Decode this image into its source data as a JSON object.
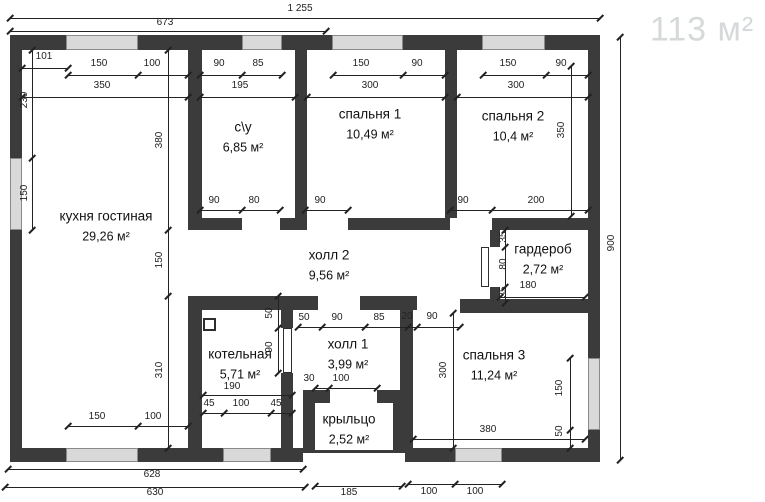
{
  "watermark": {
    "text": "113 м²"
  },
  "colors": {
    "background": "#ffffff",
    "wall": "#3b3b3b",
    "window": "#d9d9d9",
    "dim": "#222222",
    "room_text": "#111111",
    "watermark": "#d6d9da"
  },
  "rooms": [
    {
      "name": "кухня гостиная",
      "area": "29,26 м²",
      "cx": 106,
      "cy": 226,
      "w": 112
    },
    {
      "name": "с\\у",
      "area": "6,85 м²",
      "cx": 243,
      "cy": 137,
      "w": 80
    },
    {
      "name": "спальня 1",
      "area": "10,49 м²",
      "cx": 370,
      "cy": 124,
      "w": 120
    },
    {
      "name": "спальня 2",
      "area": "10,4 м²",
      "cx": 513,
      "cy": 126,
      "w": 120
    },
    {
      "name": "гардероб",
      "area": "2,72 м²",
      "cx": 543,
      "cy": 259,
      "w": 110
    },
    {
      "name": "холл 2",
      "area": "9,56 м²",
      "cx": 329,
      "cy": 265,
      "w": 110
    },
    {
      "name": "котельная",
      "area": "5,71 м²",
      "cx": 240,
      "cy": 364,
      "w": 110
    },
    {
      "name": "холл 1",
      "area": "3,99 м²",
      "cx": 348,
      "cy": 354,
      "w": 100
    },
    {
      "name": "спальня 3",
      "area": "11,24 м²",
      "cx": 494,
      "cy": 365,
      "w": 120
    },
    {
      "name": "крыльцо",
      "area": "2,52 м²",
      "cx": 349,
      "cy": 429,
      "w": 100
    }
  ],
  "plan": {
    "walls": [
      [
        10,
        35,
        590,
        15
      ],
      [
        10,
        35,
        12,
        427
      ],
      [
        588,
        35,
        12,
        427
      ],
      [
        10,
        448,
        293,
        14
      ],
      [
        405,
        448,
        195,
        14
      ],
      [
        188,
        50,
        14,
        180
      ],
      [
        188,
        296,
        14,
        152
      ],
      [
        295,
        50,
        12,
        180
      ],
      [
        445,
        50,
        12,
        168
      ],
      [
        188,
        218,
        54,
        12
      ],
      [
        280,
        218,
        25,
        12
      ],
      [
        348,
        218,
        102,
        12
      ],
      [
        492,
        218,
        108,
        12
      ],
      [
        188,
        296,
        130,
        14
      ],
      [
        360,
        296,
        57,
        14
      ],
      [
        460,
        299,
        140,
        14
      ],
      [
        281,
        296,
        12,
        32
      ],
      [
        281,
        373,
        12,
        75
      ],
      [
        400,
        296,
        13,
        152
      ],
      [
        490,
        230,
        10,
        17
      ],
      [
        490,
        287,
        10,
        26
      ],
      [
        490,
        303,
        110,
        10
      ],
      [
        303,
        390,
        27,
        13
      ],
      [
        377,
        390,
        28,
        13
      ],
      [
        303,
        403,
        12,
        50
      ],
      [
        393,
        403,
        12,
        50
      ]
    ],
    "windows": [
      [
        66,
        35,
        72,
        15
      ],
      [
        242,
        35,
        40,
        15
      ],
      [
        332,
        35,
        71,
        15
      ],
      [
        482,
        35,
        63,
        15
      ],
      [
        10,
        158,
        12,
        72
      ],
      [
        66,
        448,
        72,
        14
      ],
      [
        223,
        448,
        48,
        14
      ],
      [
        455,
        448,
        47,
        14
      ],
      [
        588,
        358,
        12,
        72
      ]
    ],
    "door_leaves": [
      [
        481,
        247,
        8,
        40
      ],
      [
        283,
        328,
        9,
        45
      ]
    ],
    "boiler_box": [
      203,
      318,
      13,
      13
    ],
    "porch_edge": [
      303,
      450,
      102,
      3
    ],
    "dim_lines": [
      [
        10,
        18,
        590,
        0,
        [
          10,
          600
        ]
      ],
      [
        10,
        31,
        316,
        0,
        [
          10,
          326
        ]
      ],
      [
        22,
        68,
        46,
        0,
        [
          22,
          68
        ]
      ],
      [
        68,
        75,
        120,
        0,
        [
          68,
          138,
          188
        ]
      ],
      [
        200,
        75,
        82,
        0,
        [
          200,
          242,
          282
        ]
      ],
      [
        333,
        75,
        112,
        0,
        [
          333,
          403,
          445
        ]
      ],
      [
        483,
        75,
        105,
        0,
        [
          483,
          546,
          588
        ]
      ],
      [
        22,
        97,
        166,
        0,
        [
          22,
          188
        ]
      ],
      [
        200,
        97,
        95,
        0,
        [
          200,
          295
        ]
      ],
      [
        307,
        97,
        138,
        0,
        [
          307,
          445
        ]
      ],
      [
        457,
        97,
        131,
        0,
        [
          457,
          588
        ]
      ],
      [
        32,
        50,
        180,
        1,
        [
          50,
          158,
          230
        ]
      ],
      [
        168,
        50,
        398,
        1,
        [
          50,
          230,
          296,
          448
        ]
      ],
      [
        571,
        66,
        150,
        1,
        [
          66,
          216
        ]
      ],
      [
        620,
        37,
        423,
        1,
        [
          37,
          460
        ]
      ],
      [
        200,
        210,
        80,
        0,
        [
          200,
          242,
          280
        ]
      ],
      [
        305,
        210,
        43,
        0,
        [
          305,
          348
        ]
      ],
      [
        450,
        210,
        138,
        0,
        [
          450,
          492,
          588
        ]
      ],
      [
        505,
        230,
        73,
        1,
        [
          230,
          247,
          287,
          303
        ]
      ],
      [
        500,
        297,
        85,
        0,
        [
          500,
          585
        ]
      ],
      [
        278,
        296,
        77,
        1,
        [
          296,
          328,
          373
        ]
      ],
      [
        298,
        327,
        162,
        0,
        [
          298,
          322,
          365,
          408,
          417,
          460
        ]
      ],
      [
        315,
        388,
        62,
        0,
        [
          315,
          329,
          377
        ]
      ],
      [
        203,
        395,
        89,
        0,
        [
          203,
          292
        ]
      ],
      [
        203,
        413,
        89,
        0,
        [
          203,
          224,
          271,
          292
        ]
      ],
      [
        68,
        426,
        120,
        0,
        [
          68,
          138,
          188
        ]
      ],
      [
        453,
        313,
        135,
        1,
        [
          313,
          448
        ]
      ],
      [
        570,
        358,
        90,
        1,
        [
          358,
          430,
          448
        ]
      ],
      [
        413,
        439,
        172,
        0,
        [
          413,
          585
        ]
      ],
      [
        8,
        469,
        295,
        0,
        [
          8,
          303
        ]
      ],
      [
        5,
        487,
        300,
        0,
        [
          5,
          305
        ]
      ],
      [
        315,
        486,
        87,
        0,
        [
          315,
          402
        ]
      ],
      [
        408,
        484,
        94,
        0,
        [
          408,
          455,
          502
        ]
      ]
    ],
    "dim_labels": [
      [
        "1 255",
        300,
        9,
        0
      ],
      [
        "673",
        165,
        23,
        0
      ],
      [
        "101",
        44,
        57,
        0
      ],
      [
        "150",
        99,
        64,
        0
      ],
      [
        "100",
        152,
        64,
        0
      ],
      [
        "90",
        219,
        64,
        0
      ],
      [
        "85",
        258,
        64,
        0
      ],
      [
        "150",
        361,
        64,
        0
      ],
      [
        "90",
        417,
        64,
        0
      ],
      [
        "150",
        508,
        64,
        0
      ],
      [
        "90",
        561,
        64,
        0
      ],
      [
        "350",
        102,
        86,
        0
      ],
      [
        "195",
        240,
        86,
        0
      ],
      [
        "300",
        370,
        86,
        0
      ],
      [
        "300",
        516,
        86,
        0
      ],
      [
        "230",
        25,
        100,
        1
      ],
      [
        "150",
        25,
        193,
        1
      ],
      [
        "380",
        160,
        140,
        1
      ],
      [
        "150",
        160,
        260,
        1
      ],
      [
        "310",
        160,
        370,
        1
      ],
      [
        "350",
        562,
        130,
        1
      ],
      [
        "900",
        612,
        243,
        1
      ],
      [
        "90",
        214,
        201,
        0
      ],
      [
        "80",
        254,
        201,
        0
      ],
      [
        "90",
        320,
        201,
        0
      ],
      [
        "90",
        463,
        201,
        0
      ],
      [
        "200",
        536,
        201,
        0
      ],
      [
        "35",
        504,
        237,
        1
      ],
      [
        "80",
        504,
        264,
        1
      ],
      [
        "35",
        504,
        292,
        1
      ],
      [
        "180",
        528,
        286,
        0
      ],
      [
        "50",
        270,
        313,
        1
      ],
      [
        "90",
        270,
        347,
        1
      ],
      [
        "50",
        304,
        318,
        0
      ],
      [
        "90",
        337,
        318,
        0
      ],
      [
        "85",
        379,
        318,
        0
      ],
      [
        "20",
        407,
        317,
        0
      ],
      [
        "90",
        432,
        317,
        0
      ],
      [
        "30",
        309,
        379,
        0
      ],
      [
        "100",
        341,
        379,
        0
      ],
      [
        "190",
        232,
        387,
        0
      ],
      [
        "45",
        209,
        404,
        0
      ],
      [
        "100",
        241,
        404,
        0
      ],
      [
        "45",
        276,
        404,
        0
      ],
      [
        "150",
        97,
        417,
        0
      ],
      [
        "100",
        153,
        417,
        0
      ],
      [
        "300",
        444,
        370,
        1
      ],
      [
        "150",
        560,
        388,
        1
      ],
      [
        "50",
        560,
        431,
        1
      ],
      [
        "380",
        488,
        430,
        0
      ],
      [
        "628",
        152,
        475,
        0
      ],
      [
        "630",
        155,
        493,
        0
      ],
      [
        "185",
        349,
        493,
        0
      ],
      [
        "100",
        429,
        492,
        0
      ],
      [
        "100",
        475,
        492,
        0
      ]
    ]
  }
}
